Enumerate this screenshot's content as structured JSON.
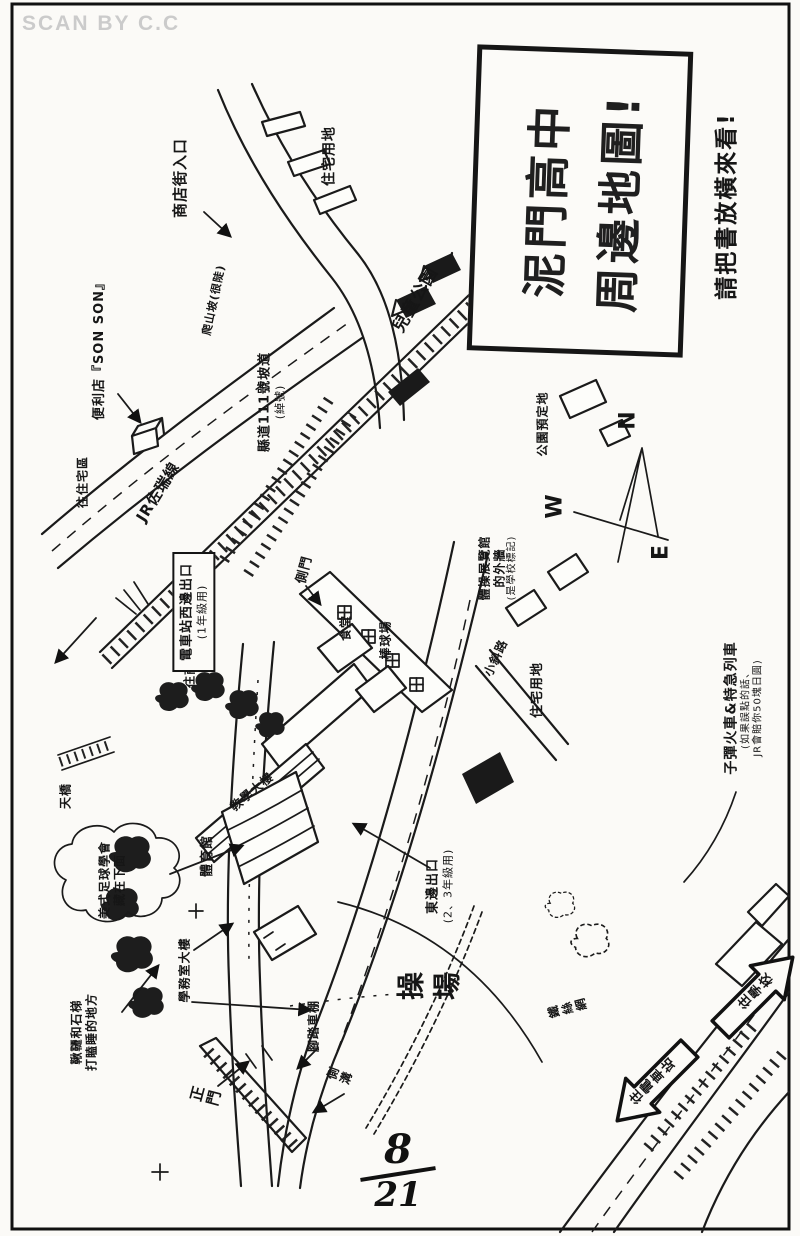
{
  "page": {
    "watermark": "SCAN BY C.C",
    "page_number": {
      "numerator": "8",
      "denominator": "21"
    }
  },
  "title_box": {
    "line1": "泥門高中",
    "line2": "周邊地圖!"
  },
  "rotate_note": "請把書放橫來看!",
  "compass": {
    "north": "N",
    "west": "W",
    "east": "E"
  },
  "labels": {
    "shop_street_entrance": "商店街入口",
    "convenience_store": "便利店『SON SON』",
    "slope_note": "爬山坡(很陡)",
    "road_111": "縣道111號坡道",
    "road_111_note": "(綽號)",
    "jr_line": "JR佐瑞線",
    "to_residential": "往住宅區",
    "to_shopping_street": "往商店街",
    "station_west_exit": "電車站西邊出口",
    "station_west_exit_note": "(1年級用)",
    "side_gate": "側門",
    "cafeteria": "食堂",
    "baseball_field": "棒球場",
    "residential_top": "住宅用地",
    "children_park": "兒童公園",
    "park_planned": "公園預定地",
    "gym_wall_note_1": "體操展覽館",
    "gym_wall_note_2": "的外牆",
    "gym_wall_note_3": "(是學校標記)",
    "small_slope_road": "小斜路",
    "residential_right": "住宅用地",
    "train_note_main": "子彈火車&特急列車",
    "train_note_sub1": "(如果誤點的話、",
    "train_note_sub2": "JR會賠你50塊日圓)",
    "footbridge": "天橋",
    "teaching_building": "教學大樓",
    "gymnasium": "體育館",
    "football_club_note_1": "美式足球學會",
    "football_club_note_2": "藏在下面",
    "east_exit": "東邊出口",
    "east_exit_note": "(2、3年級用)",
    "playground": "操場",
    "wire_fence": "鐵絲網",
    "swings_note_1": "鞦韆和石梯",
    "swings_note_2": "打瞌睡的地方",
    "admin_building": "學務室大樓",
    "main_gate": "正門",
    "bike_shed": "腳踏車棚",
    "gutter": "側溝",
    "arrow_to_school": "往學校",
    "arrow_to_station": "往電車站"
  }
}
